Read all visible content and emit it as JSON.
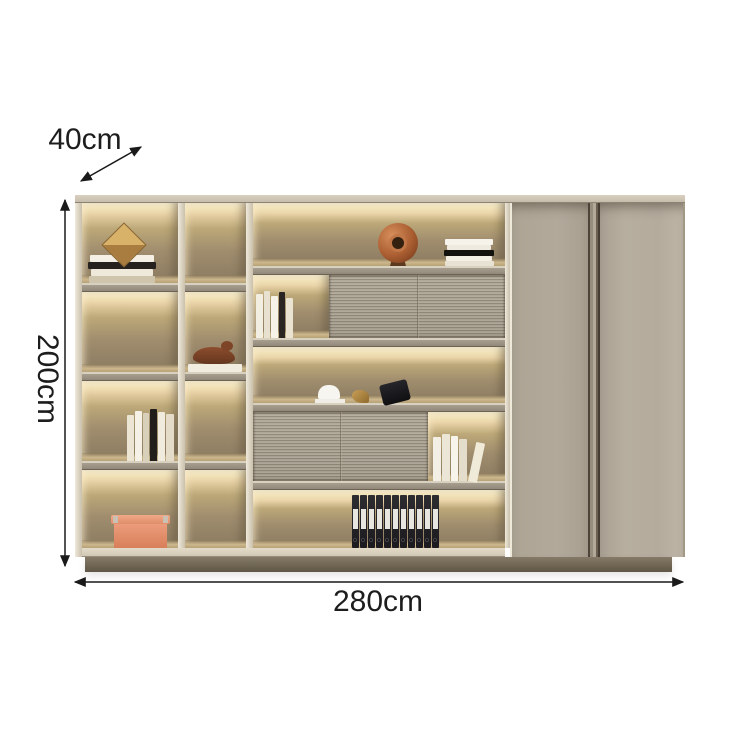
{
  "annotations": {
    "depth_label": "40cm",
    "height_label": "200cm",
    "width_label": "280cm"
  },
  "icons": {
    "depth_arrow": "double-headed-diagonal-arrow",
    "height_arrow": "double-headed-vertical-arrow",
    "width_arrow": "double-headed-horizontal-arrow"
  },
  "colors": {
    "annotation_text": "#1d1d1d",
    "arrow": "#1a1a1a",
    "cabinet_frame": "#e9e2d3",
    "cabinet_top_strip": "#cdc4b4",
    "door_panel": "#b2a99b",
    "led_glow": "#fdf4d4",
    "shelf_interior": "#9a8a6e",
    "shelf_edge": "#9d9486",
    "fluted_panel": "#aba291",
    "plinth": "#6f6554",
    "storage_box": "#e08a66",
    "copper_sculpture": "#b06236",
    "binder": "#222227"
  },
  "decor_items": [
    "cube-sculpture",
    "book-stacks",
    "bird-sculpture",
    "standing-books",
    "storage-box",
    "copper-disc-sculpture",
    "desk-objects",
    "file-binders",
    "leaning-books"
  ]
}
